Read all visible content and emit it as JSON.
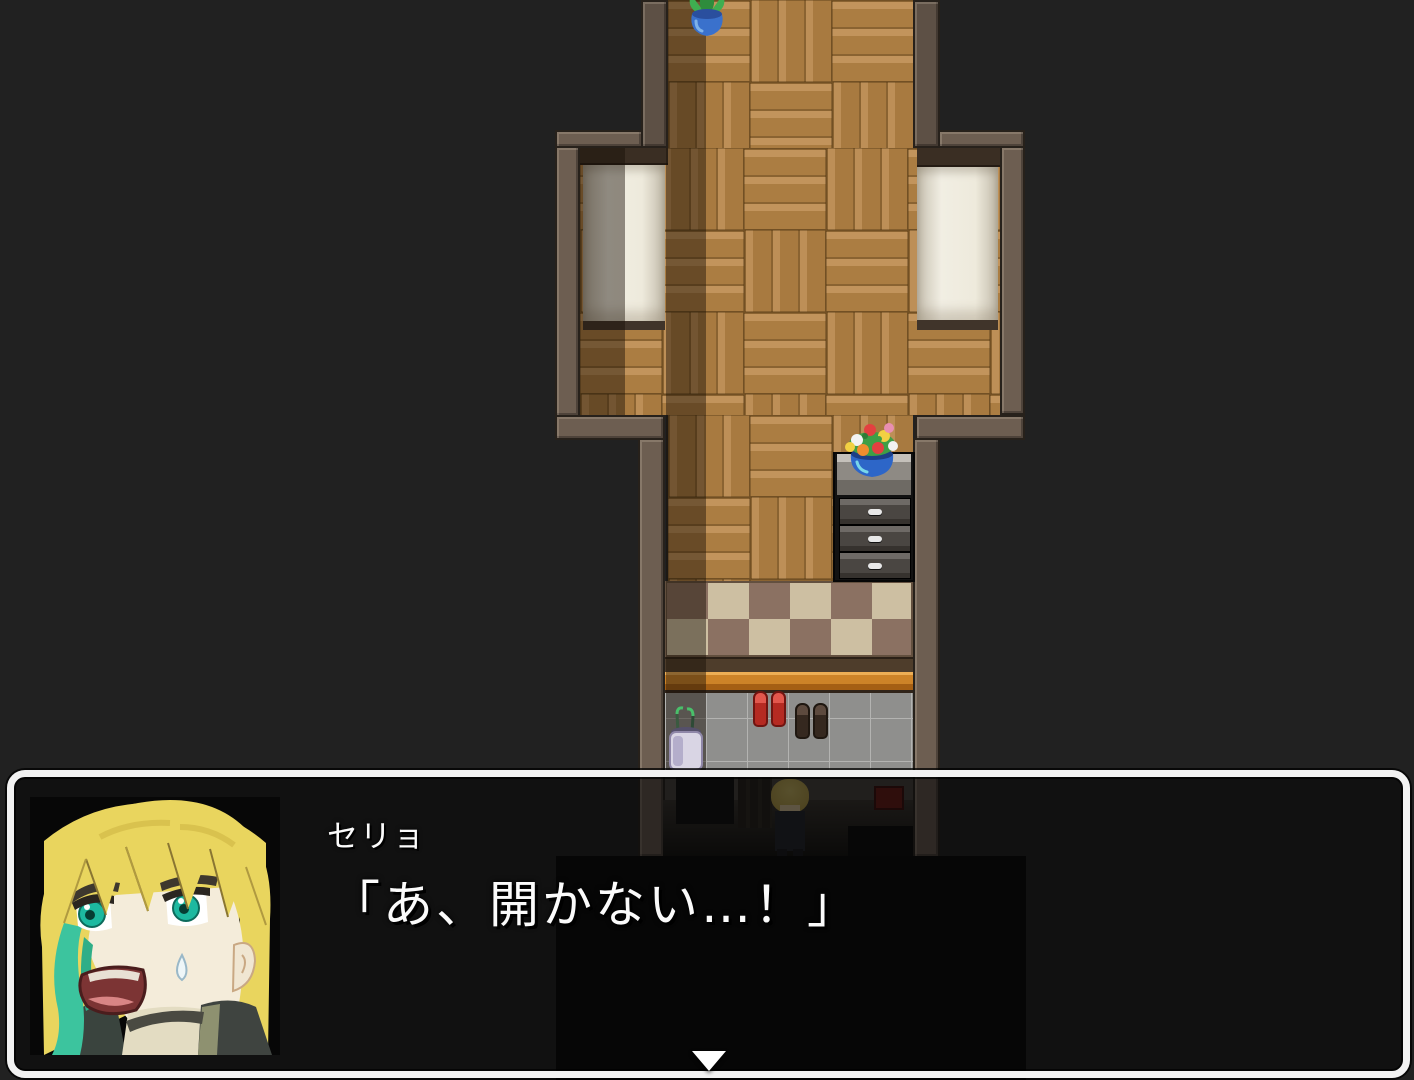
{
  "dialogue": {
    "speaker": "セリョ",
    "line": "「あ、開かない…！」"
  },
  "ui": {
    "window_border_color": "#f2f2f2",
    "window_fill": "rgba(8,8,8,0.62)",
    "continue_indicator": "down-triangle",
    "text_color": "#fbfbfb"
  },
  "scene": {
    "background_color": "#212121",
    "room": {
      "floor": "wood-parquet",
      "floor_color": "#b0834a",
      "wall_color": "#6d5e51",
      "shadow_color": "rgba(24,15,6,0.45)",
      "doormat_colors": [
        "#cdbfa2",
        "#8b7162"
      ],
      "entry_step_color": "#cd8328",
      "entry_tile_color": "#8f8f8d",
      "bed_color": "#eeeadc",
      "objects": [
        "potted-plant",
        "bed-left",
        "bed-right",
        "dresser",
        "flower-vase",
        "checkered-doormat",
        "entry-step",
        "entry-tile-floor",
        "umbrella-stand",
        "red-shoes",
        "brown-shoes",
        "player-character",
        "red-wall-sign"
      ]
    },
    "portrait": {
      "character": "セリョ",
      "hair_color": "#e9d55e",
      "eye_color": "#1db9a0",
      "accent_hair_color": "#3cc49e"
    }
  }
}
